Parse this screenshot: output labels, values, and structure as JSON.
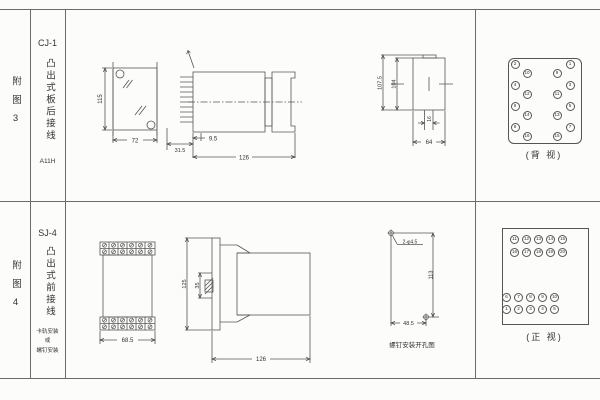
{
  "colors": {
    "table_line": "#6b6b6b",
    "drawing_line": "#555555",
    "text": "#333333",
    "background": "#fcfcfb"
  },
  "row1": {
    "index": "附图3",
    "model": "CJ-1",
    "desc": "凸出式板后接线",
    "code": "A11H",
    "panel_view": {
      "height": "115",
      "width": "72"
    },
    "side_view": {
      "panel": "31.5",
      "offset": "9.5",
      "depth": "126"
    },
    "cutout_view": {
      "outer": "107.5",
      "inner": "104",
      "slot": "16",
      "width": "64"
    },
    "terminal_back": {
      "caption": "(背 视)",
      "outer_left": [
        "2",
        "4",
        "6",
        "8"
      ],
      "inner_left": [
        "10",
        "12",
        "14",
        "16"
      ],
      "inner_right": [
        "9",
        "11",
        "13",
        "15"
      ],
      "outer_right": [
        "1",
        "3",
        "5",
        "7"
      ]
    }
  },
  "row2": {
    "index": "附图4",
    "model": "SJ-4",
    "desc": "凸出式前接线",
    "mount_note": [
      "卡轨安装",
      "或",
      "螺钉安装"
    ],
    "front_view": {
      "width": "68.5"
    },
    "side_view": {
      "height": "125",
      "rail": "35",
      "depth": "126"
    },
    "hole_view": {
      "holes": "2-φ4.5",
      "vertical": "113",
      "horizontal": "48.5",
      "caption": "螺钉安装开孔图"
    },
    "terminal_front": {
      "caption": "(正 视)",
      "row_11_15": [
        "11",
        "12",
        "13",
        "14",
        "15"
      ],
      "row_16_20": [
        "16",
        "17",
        "18",
        "19",
        "20"
      ],
      "row_6_10": [
        "6",
        "7",
        "8",
        "9",
        "10"
      ],
      "row_1_5": [
        "1",
        "2",
        "3",
        "4",
        "5"
      ]
    }
  }
}
